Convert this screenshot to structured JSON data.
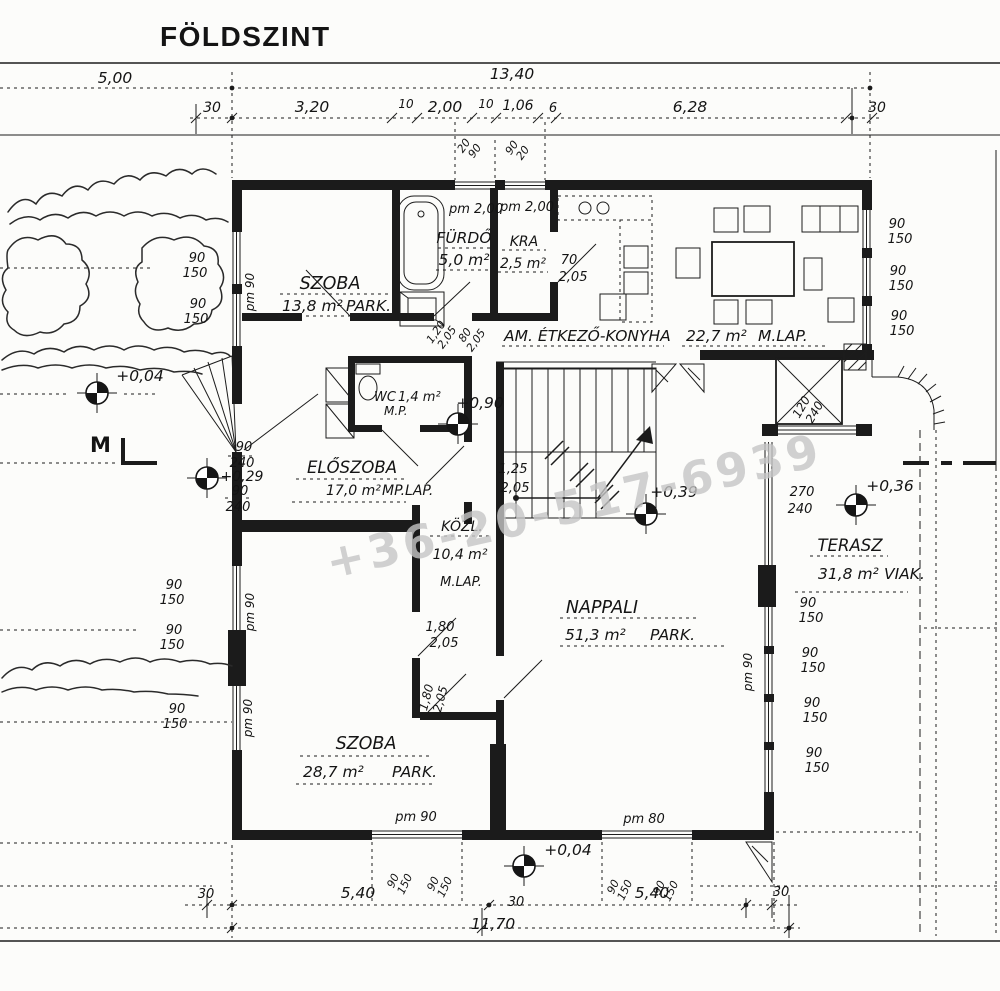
{
  "title": "FÖLDSZINT",
  "watermark": "+36-20-517-6939",
  "marker_m": "M",
  "rooms": {
    "szoba1": {
      "name": "SZOBA",
      "area": "13,8 m²",
      "floor": "PARK."
    },
    "furdo": {
      "name": "FÜRDŐ",
      "area": "5,0 m²"
    },
    "kra": {
      "name": "KRA",
      "area": "2,5 m²"
    },
    "konyha": {
      "name": "AM. ÉTKEZŐ-KONYHA",
      "area": "22,7 m²",
      "floor": "M.LAP."
    },
    "wc": {
      "name": "WC",
      "area": "1,4 m²",
      "floor": "M.P."
    },
    "eloszoba": {
      "name": "ELŐSZOBA",
      "area": "17,0 m²",
      "floor": "MP.LAP."
    },
    "kozl": {
      "name": "KÖZL.",
      "area": "10,4 m²",
      "floor": "M.LAP."
    },
    "nappali": {
      "name": "NAPPALI",
      "area": "51,3 m²",
      "floor": "PARK."
    },
    "szoba2": {
      "name": "SZOBA",
      "area": "28,7 m²",
      "floor": "PARK."
    },
    "terasz": {
      "name": "TERASZ",
      "area": "31,8 m²",
      "floor": "VIAK."
    }
  },
  "dims": {
    "d500": "5,00",
    "d1340": "13,40",
    "d30": "30",
    "d320": "3,20",
    "d10": "10",
    "d200": "2,00",
    "d106": "1,06",
    "d6": "6",
    "d628": "6,28",
    "d540": "5,40",
    "d1170": "11,70"
  },
  "elev": {
    "e004": "+0,04",
    "e029": "+0,29",
    "e090": "+0,90",
    "e039": "+0,39",
    "e036": "+0,36"
  },
  "op": {
    "pm200": "pm 2,00",
    "pm90": "pm 90",
    "pm80": "pm 80",
    "n90": "90",
    "n150": "150",
    "n240": "240",
    "n270": "270",
    "n120": "120",
    "n20": "20",
    "n70": "70",
    "n205": "2,05",
    "n125": "1,25",
    "n180": "1,80",
    "n120c": "1,20",
    "n80": "80"
  }
}
